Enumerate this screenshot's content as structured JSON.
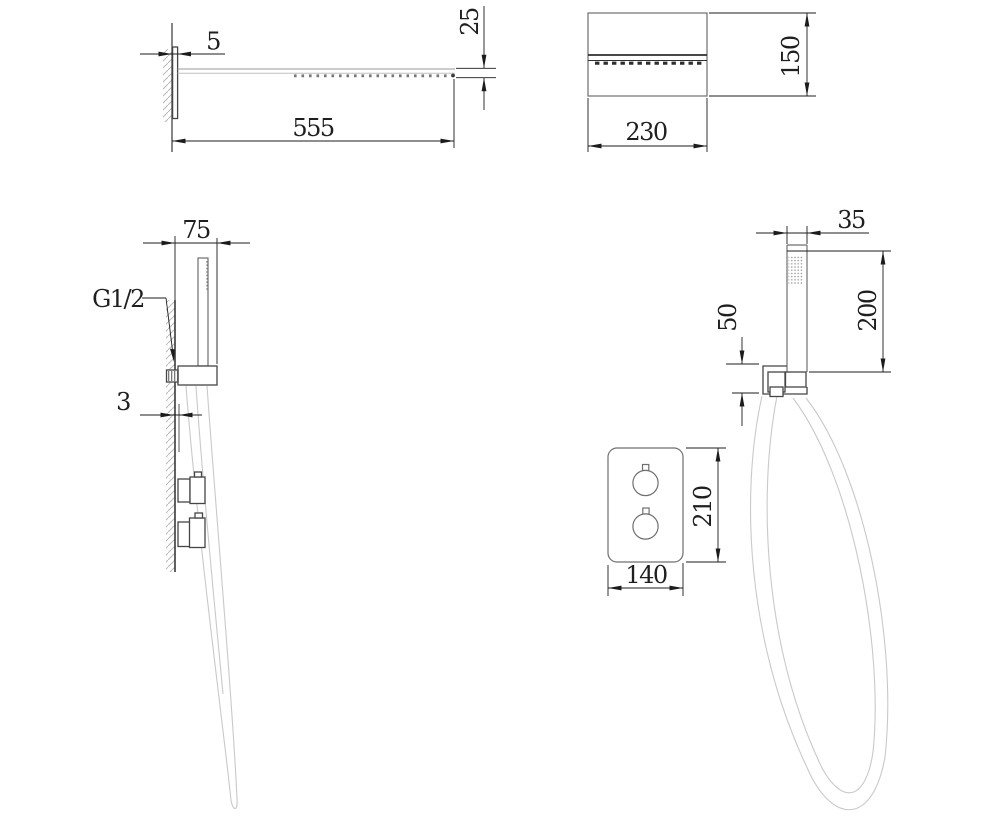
{
  "page": {
    "background": "#ffffff"
  },
  "dimensions": {
    "rain_head_side": {
      "wall_plate_thickness": "5",
      "head_depth": "25",
      "head_length": "555"
    },
    "rain_head_front": {
      "width": "230",
      "height": "150"
    },
    "hand_shower_side": {
      "bracket_offset": "75",
      "thread_label": "G1/2",
      "plate_gap": "3"
    },
    "hand_shower_front": {
      "width": "35",
      "handle_length": "200",
      "outlet_offset": "50"
    },
    "valve_plate_front": {
      "width": "140",
      "height": "210"
    }
  },
  "colors": {
    "dimension_ink": "#1c1c1c",
    "object_line": "#4a4a4a",
    "secondary_line": "#6f6f6f",
    "light_line": "#9a9a9a",
    "hose_line": "#c9c9c9",
    "hatch_line": "#b8b8b8"
  }
}
